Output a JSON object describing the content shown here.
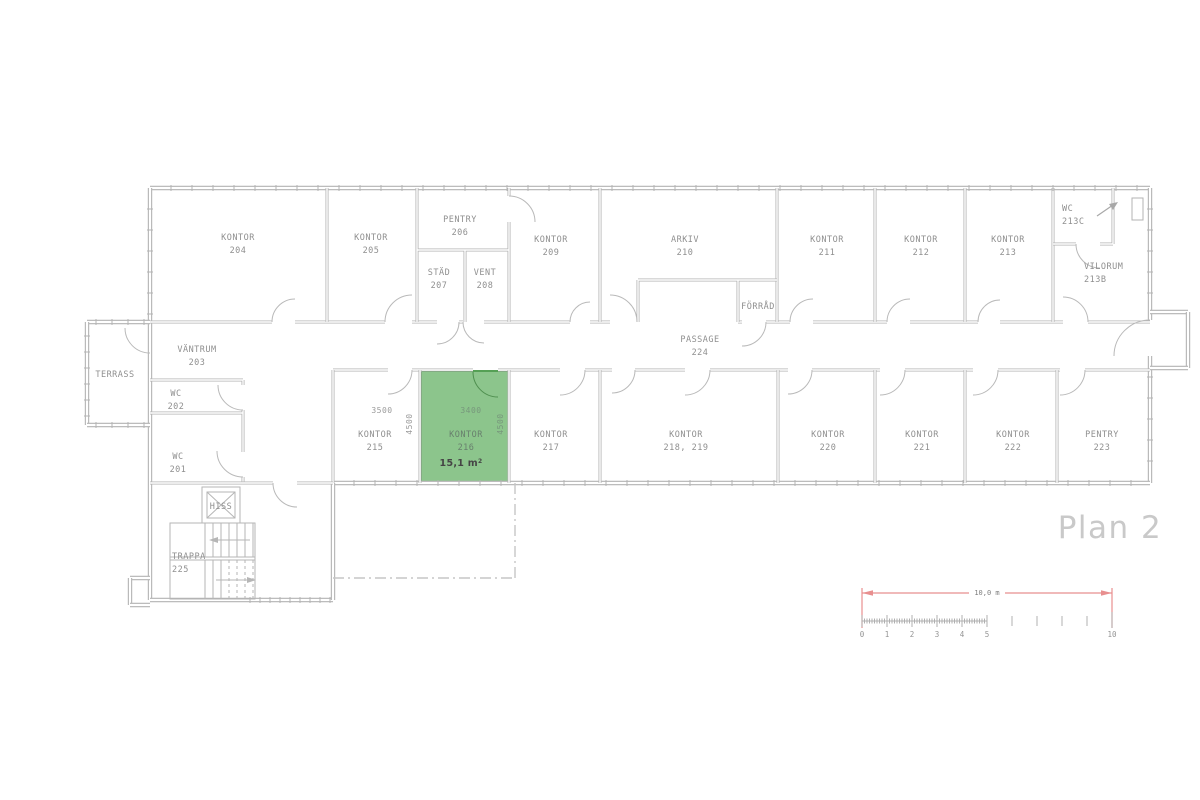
{
  "title": "Plan 2",
  "highlight": {
    "name": "KONTOR",
    "number": "216",
    "area": "15,1 m",
    "area_sup": "2",
    "fill": "#8cc58c",
    "border": "#55a055",
    "door_color": "#4f8f4f"
  },
  "rooms": [
    {
      "name": "KONTOR",
      "number": "204",
      "x": 238,
      "y": 240
    },
    {
      "name": "KONTOR",
      "number": "205",
      "x": 371,
      "y": 240
    },
    {
      "name": "PENTRY",
      "number": "206",
      "x": 460,
      "y": 222
    },
    {
      "name": "STÄD",
      "number": "207",
      "x": 439,
      "y": 275
    },
    {
      "name": "VENT",
      "number": "208",
      "x": 485,
      "y": 275
    },
    {
      "name": "KONTOR",
      "number": "209",
      "x": 551,
      "y": 242
    },
    {
      "name": "ARKIV",
      "number": "210",
      "x": 685,
      "y": 242
    },
    {
      "name": "FÖRRÅD",
      "number": "",
      "x": 758,
      "y": 309,
      "size": 7.5
    },
    {
      "name": "KONTOR",
      "number": "211",
      "x": 827,
      "y": 242
    },
    {
      "name": "KONTOR",
      "number": "212",
      "x": 921,
      "y": 242
    },
    {
      "name": "KONTOR",
      "number": "213",
      "x": 1008,
      "y": 242
    },
    {
      "name": "WC",
      "number": "213C",
      "x": 1062,
      "y": 211,
      "anchor": "start"
    },
    {
      "name": "VILORUM",
      "number": "213B",
      "x": 1084,
      "y": 269,
      "anchor": "start"
    },
    {
      "name": "VÄNTRUM",
      "number": "203",
      "x": 197,
      "y": 352
    },
    {
      "name": "TERRASS",
      "number": "",
      "x": 115,
      "y": 377
    },
    {
      "name": "WC",
      "number": "202",
      "x": 176,
      "y": 396
    },
    {
      "name": "WC",
      "number": "201",
      "x": 178,
      "y": 459
    },
    {
      "name": "PASSAGE",
      "number": "224",
      "x": 700,
      "y": 342
    },
    {
      "name": "KONTOR",
      "number": "215",
      "x": 375,
      "y": 437
    },
    {
      "name": "KONTOR",
      "number": "217",
      "x": 551,
      "y": 437
    },
    {
      "name": "KONTOR",
      "number": "218, 219",
      "x": 686,
      "y": 437
    },
    {
      "name": "KONTOR",
      "number": "220",
      "x": 828,
      "y": 437
    },
    {
      "name": "KONTOR",
      "number": "221",
      "x": 922,
      "y": 437
    },
    {
      "name": "KONTOR",
      "number": "222",
      "x": 1013,
      "y": 437
    },
    {
      "name": "PENTRY",
      "number": "223",
      "x": 1102,
      "y": 437
    },
    {
      "name": "TRAPPA",
      "number": "225",
      "x": 172,
      "y": 559,
      "anchor": "start"
    },
    {
      "name": "HISS",
      "number": "",
      "x": 221,
      "y": 509,
      "size": 7
    }
  ],
  "dimensions": [
    {
      "text": "3500",
      "x": 382,
      "y": 413,
      "rotated": false,
      "in_green": false
    },
    {
      "text": "3400",
      "x": 471,
      "y": 413,
      "rotated": false,
      "in_green": true
    },
    {
      "text": "4500",
      "x": 412,
      "y": 424,
      "rotated": true,
      "in_green": false
    },
    {
      "text": "4500",
      "x": 503,
      "y": 424,
      "rotated": true,
      "in_green": true
    }
  ],
  "scalebar": {
    "label": "10,0 m",
    "numbers": [
      {
        "label": "0",
        "x": 862
      },
      {
        "label": "1",
        "x": 887
      },
      {
        "label": "2",
        "x": 912
      },
      {
        "label": "3",
        "x": 937
      },
      {
        "label": "4",
        "x": 962
      },
      {
        "label": "5",
        "x": 987
      },
      {
        "label": "10",
        "x": 1112
      }
    ],
    "color": "#e88f8f"
  },
  "colors": {
    "wall": "#b3b3b3",
    "door": "#b9b9b9",
    "text": "#8f8f8f",
    "dashed": "#c6c6c6"
  }
}
